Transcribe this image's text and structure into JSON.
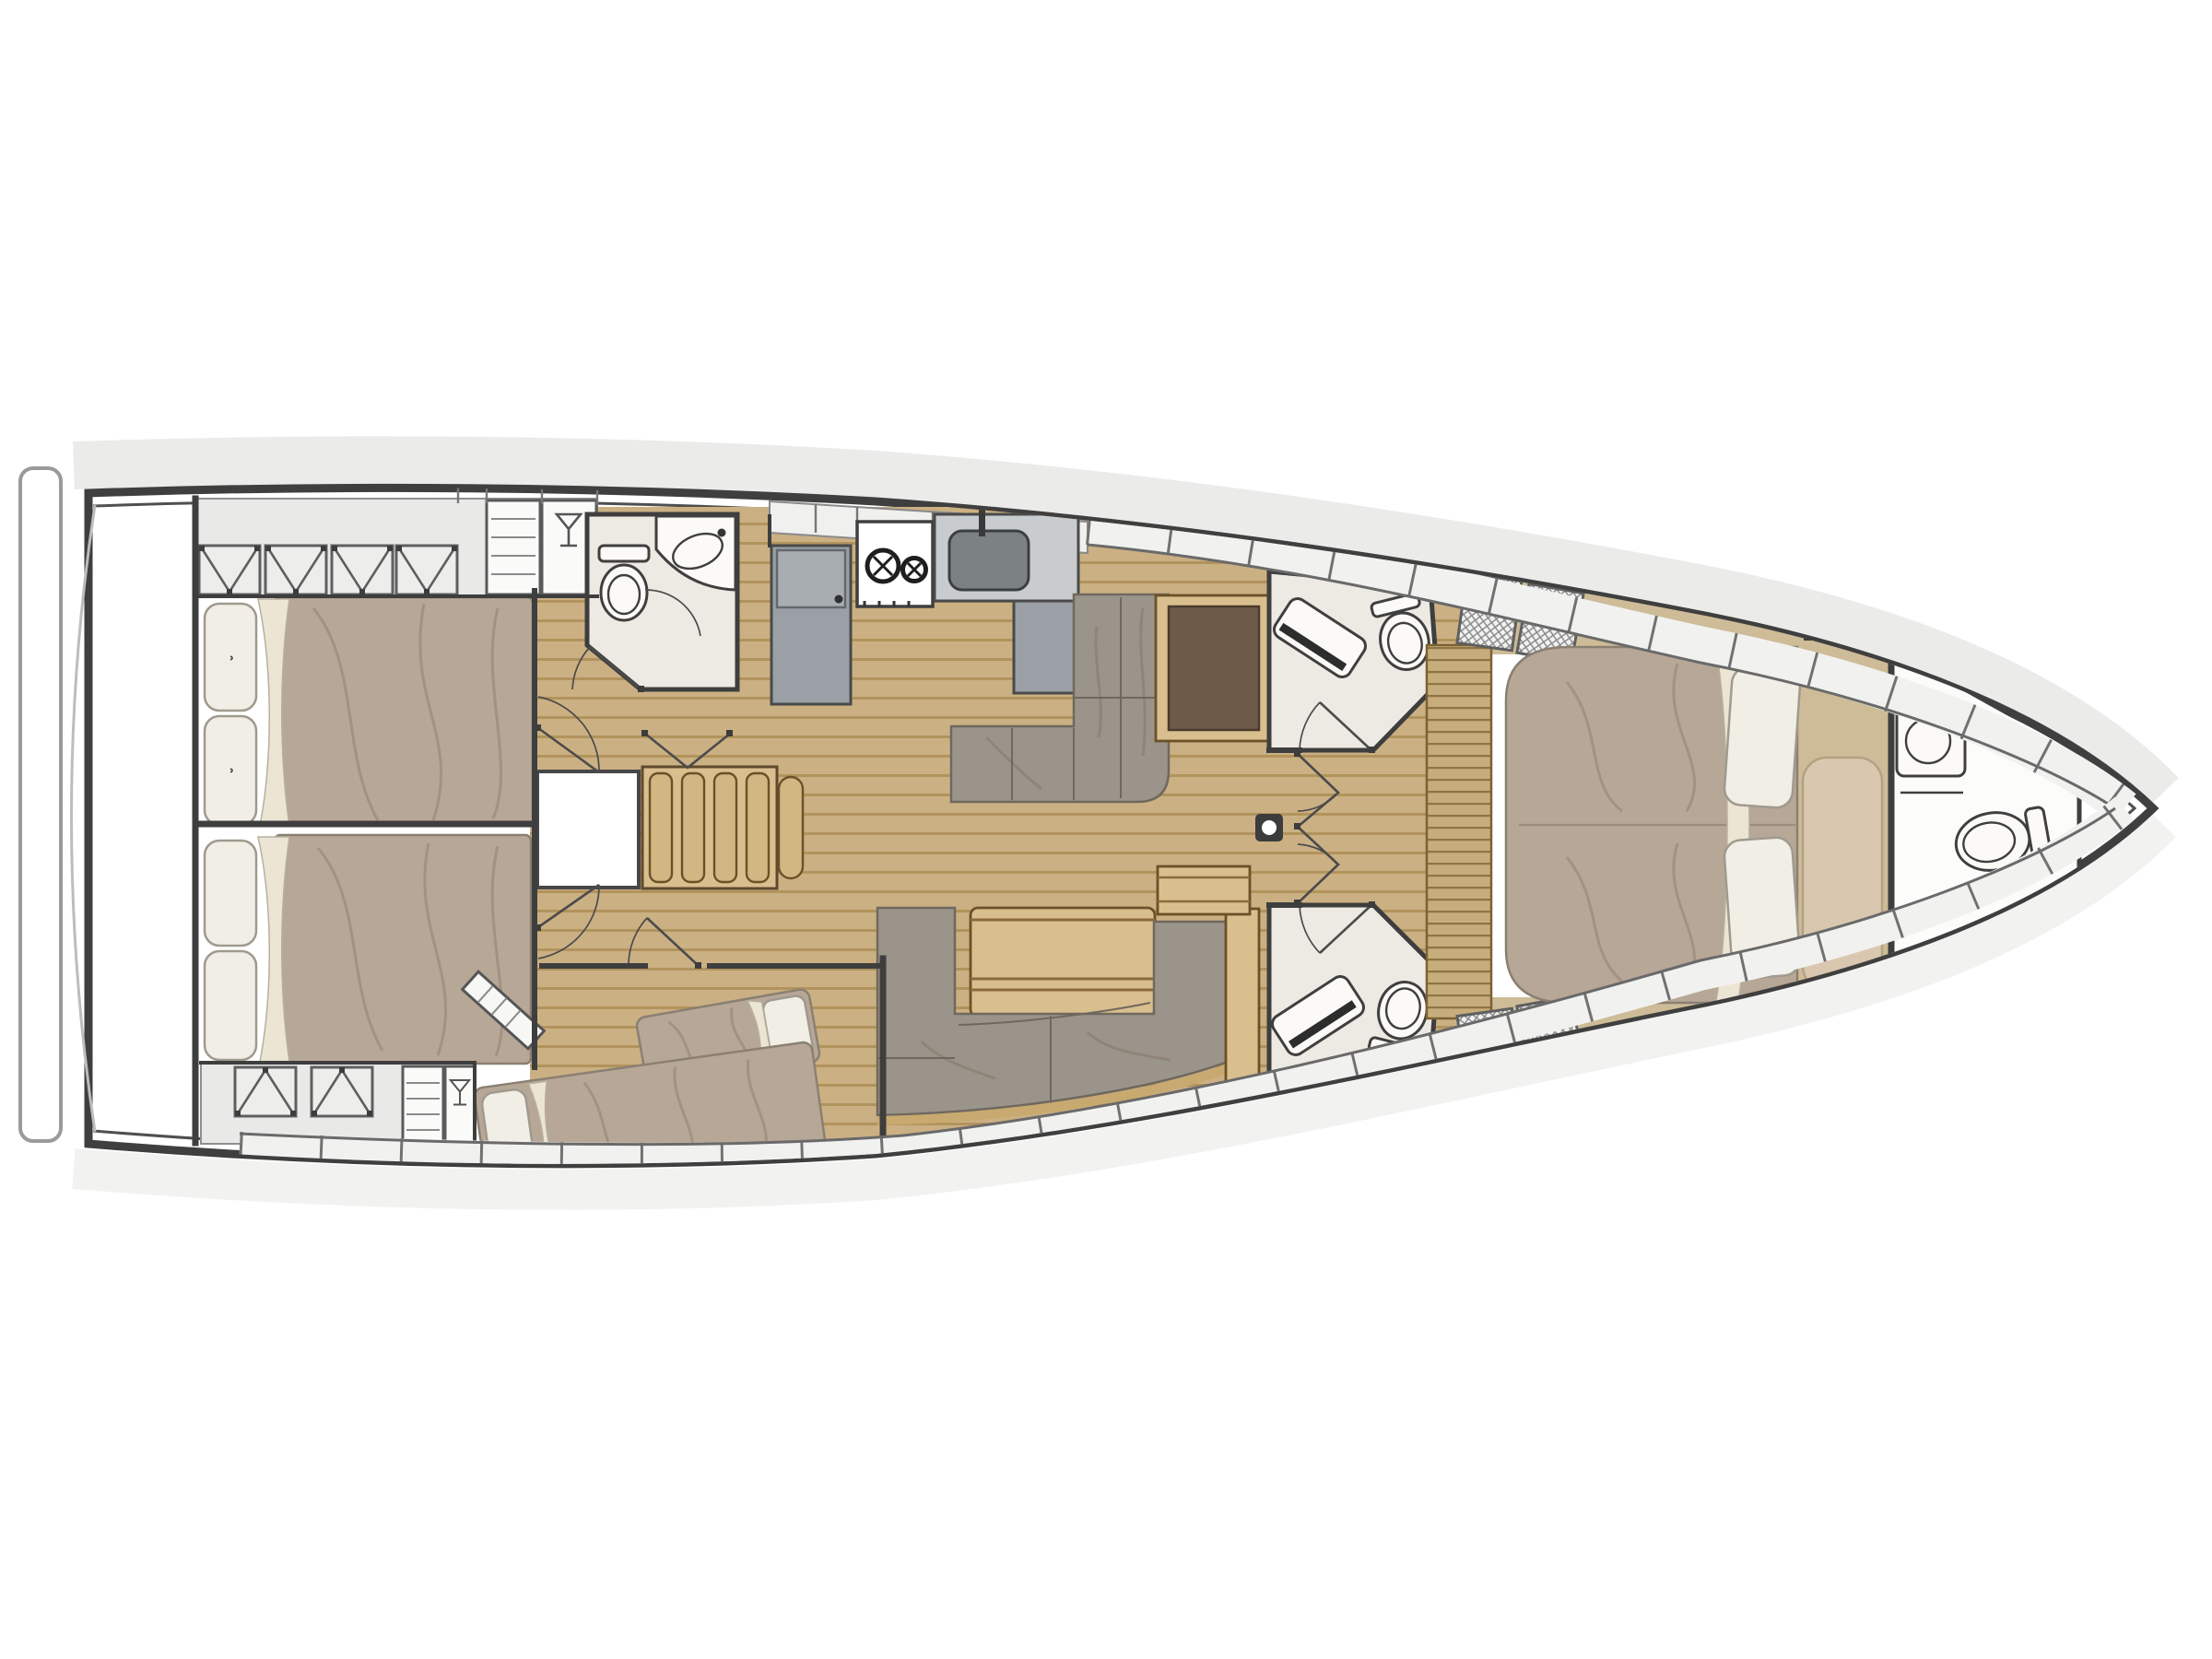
{
  "meta": {
    "title": "Sailing yacht interior layout plan",
    "view": "top-down deck / accommodation plan",
    "orientation": "bow to the right, stern (transom) to the left",
    "visible_text": []
  },
  "palette": {
    "background": "#ffffff",
    "hull_outline": "#3f3f3f",
    "hull_fill": "#ffffff",
    "hull_shadow": "#e7e7e5",
    "deck_band": "#f1f1f0",
    "wall": "#3e3e3e",
    "wood_floor": "#cbb083",
    "plank_line": "#a8894f",
    "wood_light": "#d9bf8e",
    "khaki_floor": "#cdbc97",
    "slat_line": "#8f7444",
    "duvet": "#b7a797",
    "pillow": "#f1eee6",
    "pillow_line": "#a09a8e",
    "sheet": "#ece5d4",
    "sofa": "#9b948a",
    "sofa_line": "#6f685e",
    "counter": "#f0f0ef",
    "appliance": "#9aa0a5",
    "appliance_dark": "#7c8184",
    "head_floor": "#edeae3",
    "white_fixture": "#fbfaf7",
    "walnut": "#6e5a49",
    "headboard": "#d9c8af",
    "hatch_bg": "#f2f2f2",
    "hatch_line": "#8a8a8a"
  },
  "rooms": [
    {
      "id": "transom-platform",
      "features": [
        "swim platform outline"
      ]
    },
    {
      "id": "aft-cabin-port",
      "features": [
        "double-berth",
        "two-pillows",
        "x-front-wardrobes",
        "shelf-locker",
        "glass-locker"
      ]
    },
    {
      "id": "aft-cabin-starboard",
      "features": [
        "double-berth",
        "two-pillows",
        "x-front-wardrobes",
        "shelf-locker",
        "glass-locker"
      ]
    },
    {
      "id": "companionway",
      "features": [
        "stairs-4-treads",
        "hatch-panel",
        "swing-doors"
      ]
    },
    {
      "id": "mid-cabin-starboard",
      "features": [
        "two-single-berths-head-to-toe",
        "glazed-partition"
      ]
    },
    {
      "id": "aft-head-port",
      "features": [
        "toilet",
        "corner-sink",
        "door-arc"
      ]
    },
    {
      "id": "galley",
      "features": [
        "refrigerator",
        "two-burner-stove",
        "sink",
        "counters"
      ]
    },
    {
      "id": "salon-settee-port",
      "features": [
        "l-shaped-sofa",
        "walnut-sideboard"
      ]
    },
    {
      "id": "salon-dinette-starboard",
      "features": [
        "u-shaped-sofa",
        "wood-table",
        "side-table"
      ]
    },
    {
      "id": "mast-post",
      "features": [
        "compression-post"
      ]
    },
    {
      "id": "forward-head-port",
      "features": [
        "shower-bench",
        "toilet",
        "door-arc"
      ]
    },
    {
      "id": "forward-head-starboard",
      "features": [
        "shower-bench",
        "toilet",
        "door-arc"
      ]
    },
    {
      "id": "owner-cabin-forward",
      "features": [
        "island-double-berth",
        "two-pillows",
        "headboard-cushion",
        "hatched-lockers",
        "side-slat-bench"
      ]
    },
    {
      "id": "bow-head",
      "features": [
        "sink",
        "toilet",
        "door"
      ]
    },
    {
      "id": "anchor-locker",
      "features": [
        "bow-compartment"
      ]
    }
  ],
  "icons": [
    "martini-glass-icon",
    "stove-burner-icon",
    "toilet-icon",
    "sink-icon",
    "shower-bench-icon",
    "mast-post-icon",
    "stairs-icon"
  ]
}
